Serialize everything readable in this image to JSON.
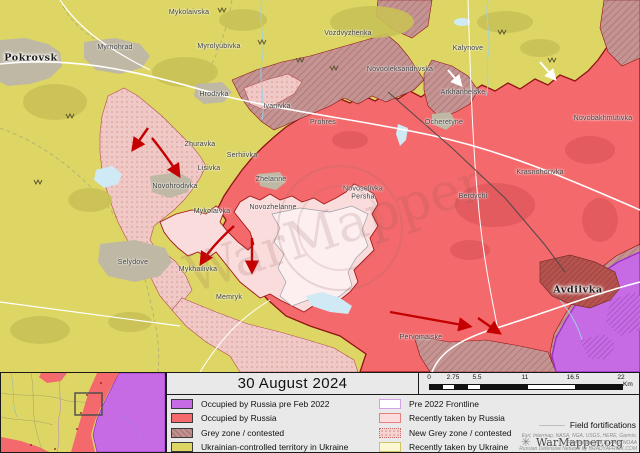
{
  "title": "30 August 2024",
  "scale_bar": {
    "unit": "Km",
    "ticks": [
      {
        "label": "0",
        "x": 10
      },
      {
        "label": "2.75",
        "x": 34
      },
      {
        "label": "5.5",
        "x": 58
      },
      {
        "label": "11",
        "x": 106
      },
      {
        "label": "16.5",
        "x": 154
      },
      {
        "label": "22",
        "x": 202
      }
    ]
  },
  "legend": {
    "left_column": [
      {
        "label": "Occupied by Russia pre Feb 2022",
        "swatch": "fill",
        "color": "#c76be4"
      },
      {
        "label": "Occupied by Russia",
        "swatch": "fill",
        "color": "#f4696b"
      },
      {
        "label": "Grey zone / contested",
        "swatch": "hatch",
        "color": ""
      },
      {
        "label": "Ukrainian-controlled territory in Ukraine",
        "swatch": "fill",
        "color": "#ddd664"
      }
    ],
    "right_column": [
      {
        "label": "Pre 2022 Frontline",
        "swatch": "outline",
        "color": "#ffffff"
      },
      {
        "label": "Recently taken by Russia",
        "swatch": "fill",
        "color": "#fbdcdc",
        "border": "#e87f7f"
      },
      {
        "label": "New Grey zone / contested",
        "swatch": "dots",
        "color": ""
      },
      {
        "label": "Recently taken by Ukraine",
        "swatch": "fill",
        "color": "#fcf8d2",
        "border": "#cfc468"
      }
    ],
    "field_fortifications_label": "Field fortifications",
    "brand_star": "✳",
    "brand": "WarMapper.org",
    "attribution_line1": "Esri, Intermap, NASA, NGA, USGS, HERE, Garmin,",
    "attribution_line2": "Foursquare, METI, FAO, NOAA",
    "attribution_line3": "Russian Defensive Network by BRADYAFRICK.COM"
  },
  "map": {
    "watermark": "WarMapper",
    "colors": {
      "ukraine_controlled": "#ddd664",
      "occupied_by_russia": "#f4696b",
      "occupied_pre_2022": "#c76be4",
      "recently_taken_by_russia": "#fbdcdc",
      "grey_zone": "#c49392",
      "new_grey_zone": "#f6d3d0",
      "water": "#cfe9f5",
      "urban": "#bfb8a4",
      "frontline": "#8f1414",
      "advance_arrow": "#c40000"
    },
    "labels": [
      {
        "name": "Pokrovsk",
        "x": 31,
        "y": 58,
        "cls": "city"
      },
      {
        "name": "Avdiivka",
        "x": 578,
        "y": 290,
        "cls": "city"
      },
      {
        "name": "Mykolaivska",
        "x": 189,
        "y": 13,
        "cls": ""
      },
      {
        "name": "Myrnohrad",
        "x": 115,
        "y": 48,
        "cls": ""
      },
      {
        "name": "Myrolyubivka",
        "x": 219,
        "y": 47,
        "cls": ""
      },
      {
        "name": "Vozdvyzhenka",
        "x": 348,
        "y": 34,
        "cls": ""
      },
      {
        "name": "Kalynove",
        "x": 468,
        "y": 49,
        "cls": ""
      },
      {
        "name": "Novooleksandrivska",
        "x": 400,
        "y": 70,
        "cls": ""
      },
      {
        "name": "Hrodivka",
        "x": 214,
        "y": 95,
        "cls": ""
      },
      {
        "name": "Ivanivka",
        "x": 277,
        "y": 107,
        "cls": ""
      },
      {
        "name": "Arkhanhelske",
        "x": 463,
        "y": 93,
        "cls": ""
      },
      {
        "name": "Novobakhmutivka",
        "x": 603,
        "y": 119,
        "cls": ""
      },
      {
        "name": "Ocheretyne",
        "x": 444,
        "y": 123,
        "cls": ""
      },
      {
        "name": "Prohres",
        "x": 323,
        "y": 123,
        "cls": ""
      },
      {
        "name": "Zhuravka",
        "x": 200,
        "y": 145,
        "cls": ""
      },
      {
        "name": "Serhiivka",
        "x": 242,
        "y": 156,
        "cls": ""
      },
      {
        "name": "Lisivka",
        "x": 209,
        "y": 169,
        "cls": ""
      },
      {
        "name": "Zhelanne",
        "x": 271,
        "y": 180,
        "cls": ""
      },
      {
        "name": "Krasnohorivka",
        "x": 540,
        "y": 173,
        "cls": ""
      },
      {
        "name": "Novohrodivka",
        "x": 175,
        "y": 187,
        "cls": ""
      },
      {
        "name": "Novoselivka\nPersha",
        "x": 363,
        "y": 193,
        "cls": ""
      },
      {
        "name": "Novozhelanne",
        "x": 273,
        "y": 208,
        "cls": ""
      },
      {
        "name": "Mykolaivka",
        "x": 212,
        "y": 212,
        "cls": ""
      },
      {
        "name": "Berdychi",
        "x": 473,
        "y": 197,
        "cls": ""
      },
      {
        "name": "Selydove",
        "x": 133,
        "y": 263,
        "cls": ""
      },
      {
        "name": "Mykhailivka",
        "x": 198,
        "y": 270,
        "cls": ""
      },
      {
        "name": "Memryk",
        "x": 229,
        "y": 298,
        "cls": ""
      },
      {
        "name": "Pervomaiske",
        "x": 421,
        "y": 338,
        "cls": ""
      }
    ]
  }
}
